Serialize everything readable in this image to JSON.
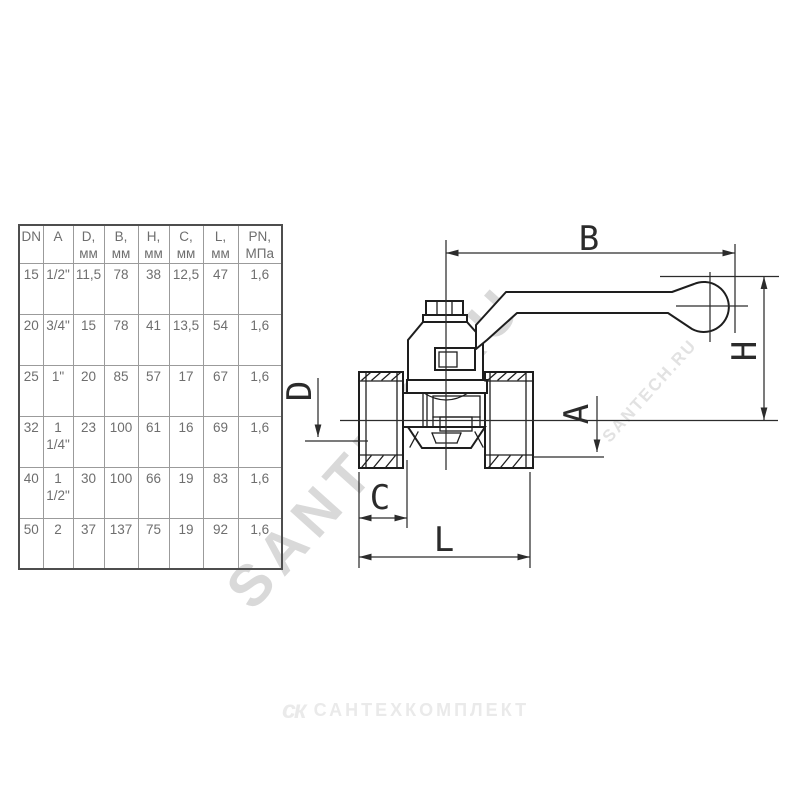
{
  "page": {
    "background_color": "#ffffff"
  },
  "watermarks": {
    "diagonal_main": "SANTEH.RU",
    "diagonal_small": "SANTECH.RU",
    "footer_logo": "ск",
    "footer_brand": "САНТЕХКОМПЛЕКТ"
  },
  "spec_table": {
    "headers": [
      "DN",
      "A",
      "D,\nмм",
      "B,\nмм",
      "H,\nмм",
      "C,\nмм",
      "L,\nмм",
      "PN,\nМПа"
    ],
    "rows": [
      [
        "15",
        "1/2\"",
        "11,5",
        "78",
        "38",
        "12,5",
        "47",
        "1,6"
      ],
      [
        "20",
        "3/4\"",
        "15",
        "78",
        "41",
        "13,5",
        "54",
        "1,6"
      ],
      [
        "25",
        "1\"",
        "20",
        "85",
        "57",
        "17",
        "67",
        "1,6"
      ],
      [
        "32",
        "1\n1/4\"",
        "23",
        "100",
        "61",
        "16",
        "69",
        "1,6"
      ],
      [
        "40",
        "1\n1/2\"",
        "30",
        "100",
        "66",
        "19",
        "83",
        "1,6"
      ],
      [
        "50",
        "2",
        "37",
        "137",
        "75",
        "19",
        "92",
        "1,6"
      ]
    ]
  },
  "drawing": {
    "labels": {
      "b": "B",
      "h": "H",
      "d": "D",
      "a": "A",
      "c": "C",
      "l": "L"
    }
  },
  "colors": {
    "drawing_line": "#1e1e1e",
    "dimension_line": "#2c2c2c",
    "table_border": "#9b9b9b",
    "table_outer_border": "#4e4e4e",
    "table_text": "#6e6e6e",
    "watermark": "#d9d9d9"
  }
}
